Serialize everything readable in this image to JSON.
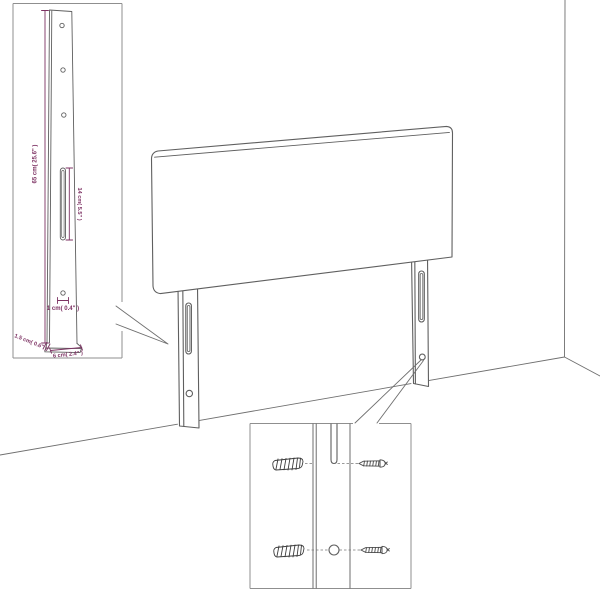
{
  "colors": {
    "background": "#ffffff",
    "drawing_line": "#5f5f5f",
    "inset_border": "#8f8f8f",
    "dimension": "#7d3263"
  },
  "side_view_inset": {
    "height_dim": "65 cm( 25.6\" )",
    "slot_dim": "14 cm( 5.5\" )",
    "hole_dim": "1 cm( 0.4\" )",
    "thickness_dim": "1.5 cm( 0.6\" )",
    "width_dim": "6 cm( 2.4\" )"
  }
}
